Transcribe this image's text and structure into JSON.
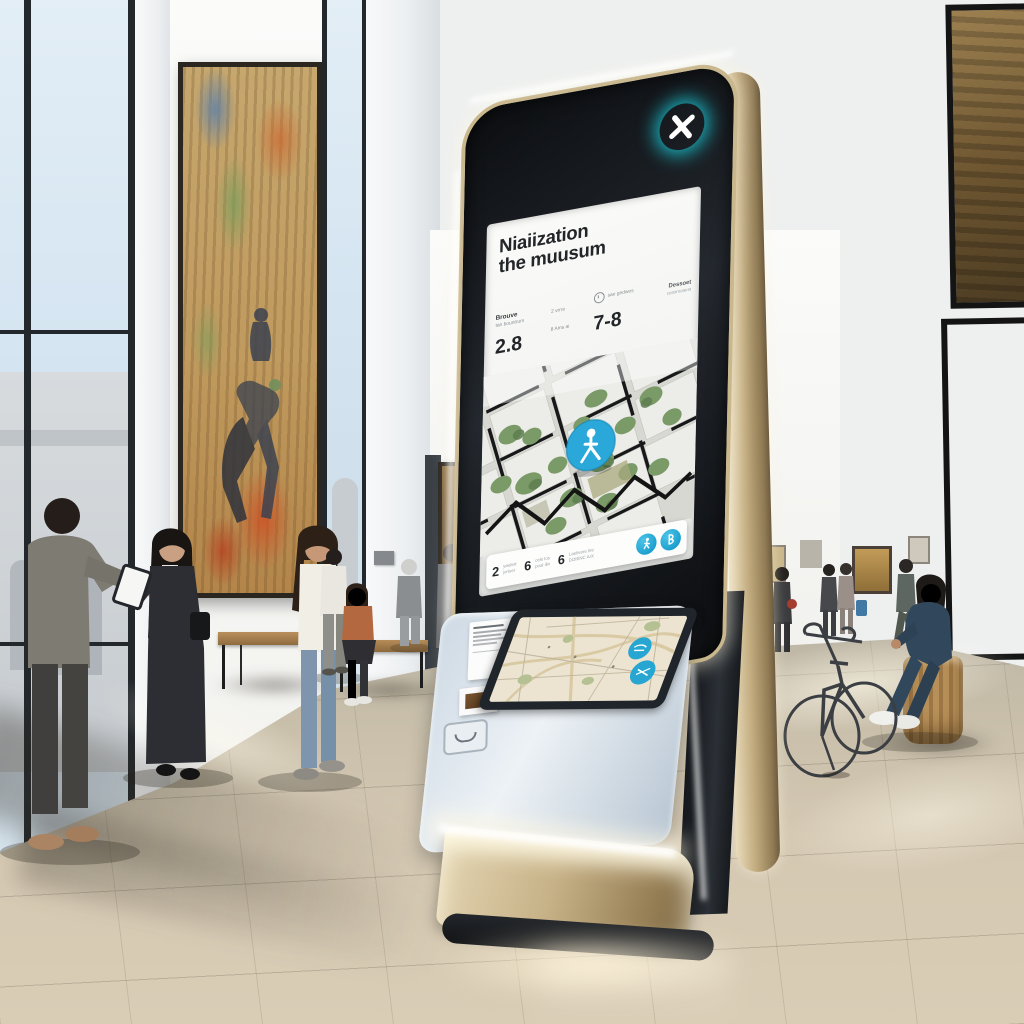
{
  "colors": {
    "badge_cyan": "#1ce2f2",
    "pin_blue": "#29a8d9",
    "button_blue": "#27a6d2",
    "kiosk_metal": "#c9b78d"
  },
  "kiosk": {
    "badge": {
      "icon": "x-logo"
    },
    "screen": {
      "title_line1": "Niaiization",
      "title_line2": "the muusum",
      "stats": {
        "col1": {
          "label": "Brouve",
          "sublabel": "tan bountrum",
          "value": "2.8"
        },
        "col2": {
          "line1": "2 vrrre",
          "line2": "8 Ams ai"
        },
        "col3": {
          "label": "sae gedwes",
          "value": "7-8"
        },
        "col4": {
          "label": "Dessoet",
          "sublabel": "costrnroterst"
        }
      },
      "bottom_bar": {
        "items": [
          {
            "num": "2",
            "line1": "yøelert",
            "line2": "jorluer"
          },
          {
            "num": "6",
            "line1": "cels los",
            "line2": "poal ilin"
          },
          {
            "num": "6",
            "line1": "Laetivere lire",
            "line2": "DOIENC ArX"
          }
        ],
        "buttons": [
          "walking-person",
          "letter-b"
        ]
      }
    }
  }
}
